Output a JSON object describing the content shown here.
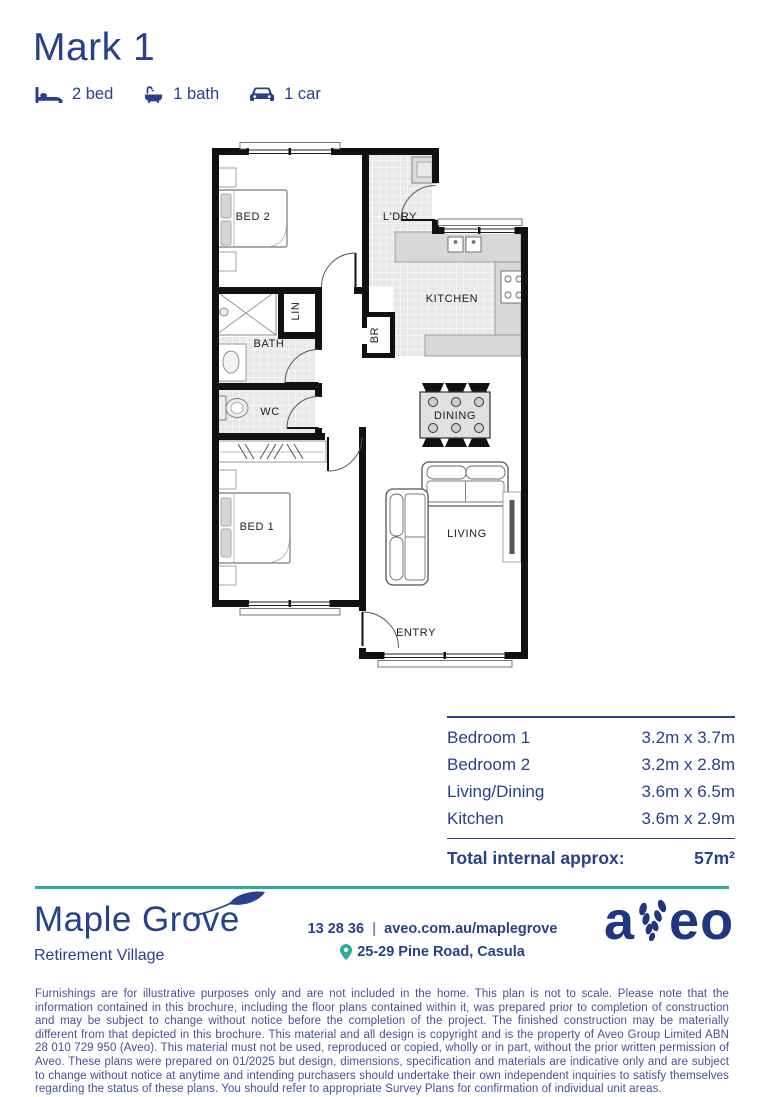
{
  "header": {
    "title": "Mark 1",
    "features": [
      {
        "icon": "bed-icon",
        "label": "2 bed"
      },
      {
        "icon": "bath-icon",
        "label": "1 bath"
      },
      {
        "icon": "car-icon",
        "label": "1 car"
      }
    ]
  },
  "floor_plan": {
    "rooms": {
      "bed2": "BED 2",
      "laundry": "L'DRY",
      "kitchen": "KITCHEN",
      "linen": "LIN",
      "broom": "BR",
      "bath": "BATH",
      "wc": "WC",
      "dining": "DINING",
      "bed1": "BED 1",
      "living": "LIVING",
      "entry": "ENTRY"
    }
  },
  "dimensions": {
    "rows": [
      {
        "label": "Bedroom 1",
        "value": "3.2m x 3.7m"
      },
      {
        "label": "Bedroom 2",
        "value": "3.2m x 2.8m"
      },
      {
        "label": "Living/Dining",
        "value": "3.6m x 6.5m"
      },
      {
        "label": "Kitchen",
        "value": "3.6m x 2.9m"
      }
    ],
    "total_label": "Total internal approx:",
    "total_value": "57m²"
  },
  "footer": {
    "village_name": "Maple Grove",
    "village_subtitle": "Retirement Village",
    "phone": "13 28 36",
    "separator": "|",
    "website": "aveo.com.au/maplegrove",
    "address": "25-29 Pine Road, Casula",
    "brand_left": "a",
    "brand_right": "eo"
  },
  "disclaimer": "Furnishings are for illustrative purposes only and are not included in the home. This plan is not to scale. Please note that the information contained in this brochure, including the floor plans contained within it, was prepared prior to completion of construction and may be subject to change without notice before the completion of the project. The finished construction may be materially different from that depicted in this brochure. This material and all design is copyright and is the property of Aveo Group Limited ABN 28 010 729 950 (Aveo). This material must not be used, reproduced or copied, wholly or in part, without the prior written permission of Aveo. These plans were prepared on 01/2025 but design, dimensions, specification and materials are indicative only and are subject to change without notice at anytime and intending purchasers should undertake their own independent inquiries to satisfy themselves regarding the status of these plans. You should refer to appropriate Survey Plans for confirmation of individual unit areas.",
  "colors": {
    "navy": "#27418f",
    "teal": "#2faa9b"
  }
}
